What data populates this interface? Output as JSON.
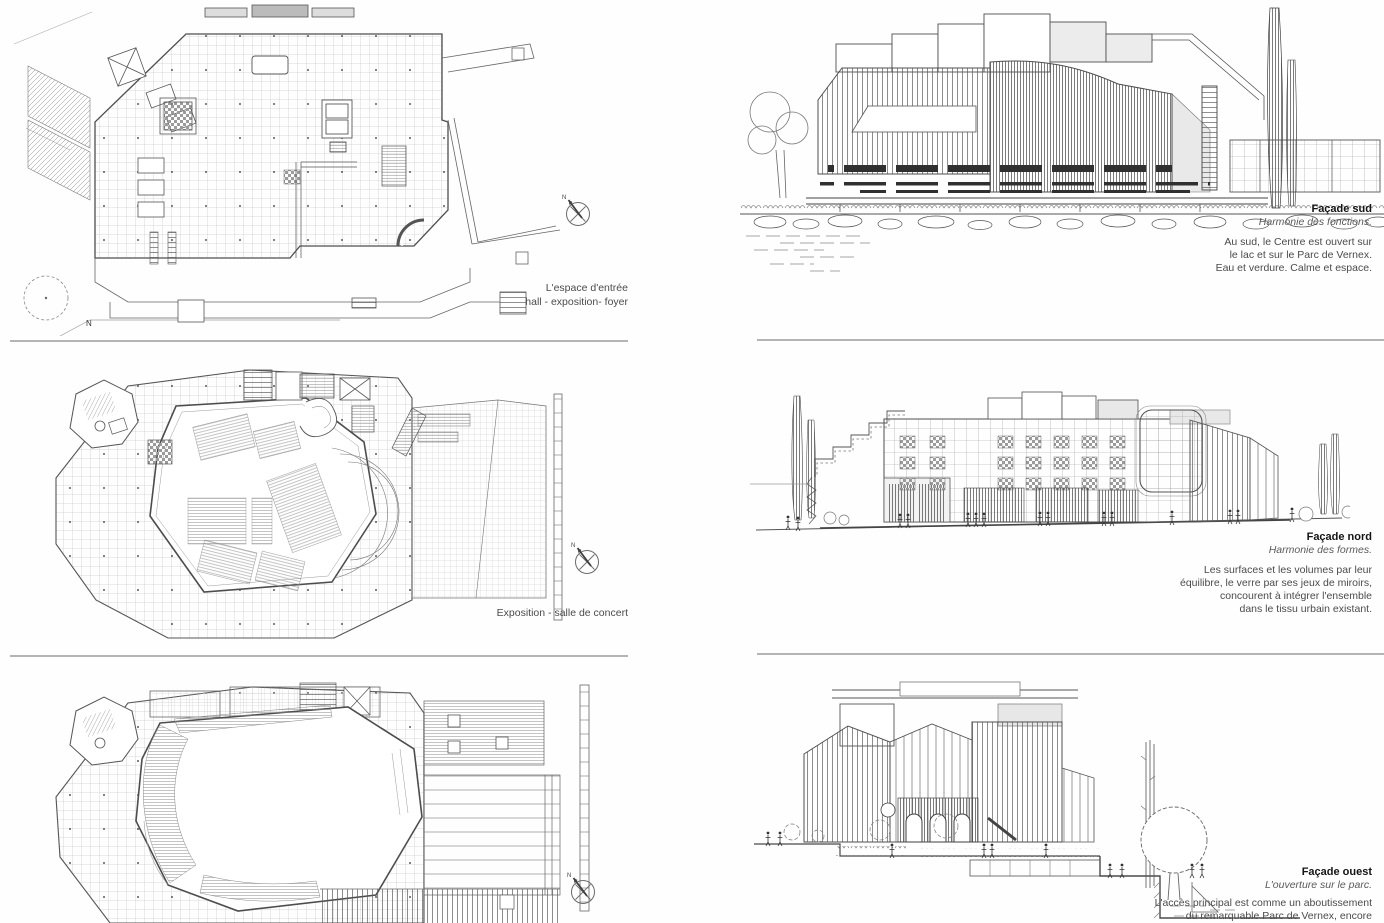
{
  "page": {
    "background": "#fefefe",
    "rule_color": "#b4b4b4"
  },
  "compass": {
    "north_label": "N"
  },
  "sections": [
    {
      "id": "entree",
      "plan_caption_lines": [
        "L'espace d'entrée",
        "hall - exposition- foyer"
      ],
      "plan_north_label": "N",
      "facade_title": "Façade sud",
      "facade_subtitle": "Harmonie des fonctions.",
      "facade_body_lines": [
        "Au sud, le Centre est ouvert sur",
        "le lac et sur le Parc de Vernex.",
        "Eau et verdure. Calme et espace."
      ]
    },
    {
      "id": "concert",
      "plan_caption_lines": [
        "Exposition - salle de concert"
      ],
      "facade_title": "Façade nord",
      "facade_subtitle": "Harmonie des formes.",
      "facade_body_lines": [
        "Les surfaces et les volumes par leur",
        "équilibre, le verre par ses jeux de miroirs,",
        "concourent à intégrer l'ensemble",
        "dans le tissu urbain existant."
      ]
    },
    {
      "id": "ouest",
      "plan_caption_lines": [],
      "facade_title": "Façade ouest",
      "facade_subtitle": "L'ouverture sur le parc.",
      "facade_body_lines": [
        "L'accès principal est comme un aboutissement",
        "du remarquable Parc de Vernex, encore"
      ]
    }
  ]
}
